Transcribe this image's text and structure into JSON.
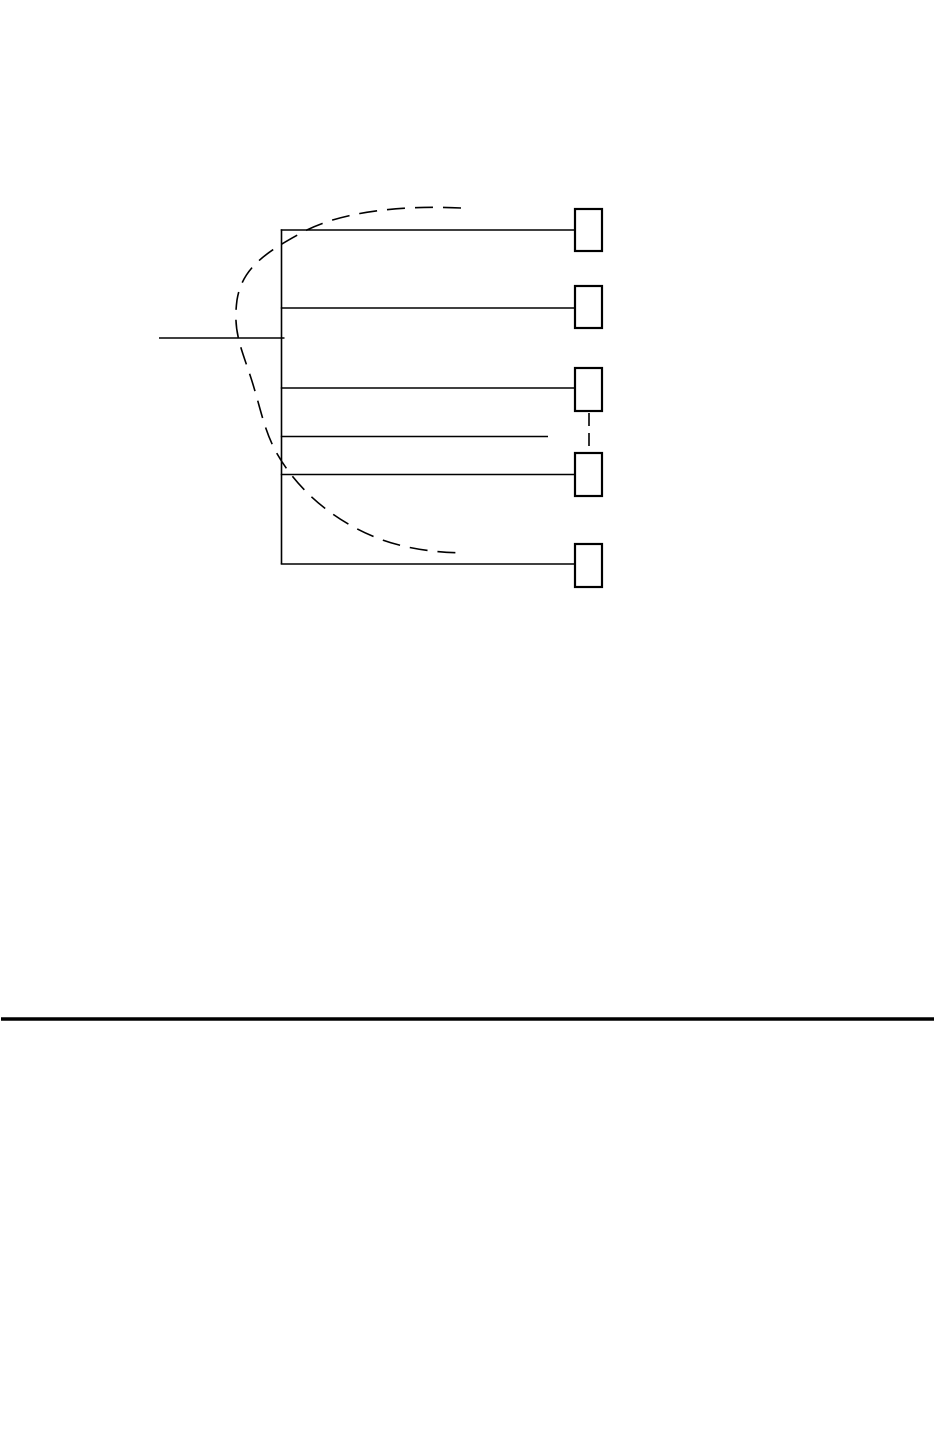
{
  "page": {
    "width": 936,
    "height": 1440,
    "background_color": "#ffffff"
  },
  "figure": {
    "description": "Fan-out line diagram: a vertical bus with horizontal branch lines ending in empty terminal boxes, a dashed grouping arc, a dashed ellipsis connector between boxes, and an input line entering from the left; a full-width separator rule sits lower on the page.",
    "stroke_color": "#000000",
    "line_width": 1.6,
    "box_stroke_width": 2.2,
    "box_fill": "#ffffff",
    "lines": [
      {
        "name": "bus-line",
        "x1": 281.5,
        "y1": 229.2,
        "x2": 281.5,
        "y2": 564
      },
      {
        "name": "branch-line-1",
        "x1": 280.7,
        "y1": 230,
        "x2": 575,
        "y2": 230
      },
      {
        "name": "branch-line-2",
        "x1": 280.7,
        "y1": 308,
        "x2": 578,
        "y2": 308
      },
      {
        "name": "branch-line-3",
        "x1": 280.7,
        "y1": 388,
        "x2": 575,
        "y2": 388
      },
      {
        "name": "branch-line-4-short",
        "x1": 280.7,
        "y1": 436.5,
        "x2": 548,
        "y2": 436.5
      },
      {
        "name": "branch-line-5",
        "x1": 280.7,
        "y1": 474.5,
        "x2": 575,
        "y2": 474.5
      },
      {
        "name": "branch-line-6",
        "x1": 280.7,
        "y1": 564,
        "x2": 574.5,
        "y2": 564
      },
      {
        "name": "input-line",
        "x1": 159,
        "y1": 338,
        "x2": 284.5,
        "y2": 338
      }
    ],
    "boxes": [
      {
        "name": "terminal-box-1",
        "x": 575,
        "y": 209,
        "w": 27,
        "h": 42
      },
      {
        "name": "terminal-box-2",
        "x": 575,
        "y": 286,
        "w": 27,
        "h": 42
      },
      {
        "name": "terminal-box-3",
        "x": 575,
        "y": 368,
        "w": 27,
        "h": 43
      },
      {
        "name": "terminal-box-4",
        "x": 575,
        "y": 453,
        "w": 27,
        "h": 43
      },
      {
        "name": "terminal-box-5",
        "x": 575,
        "y": 544,
        "w": 27,
        "h": 43
      }
    ],
    "dashed_lines": [
      {
        "name": "ellipsis-connector",
        "x1": 589,
        "y1": 413,
        "x2": 589,
        "y2": 451,
        "dash": "13 7"
      }
    ],
    "arc": {
      "name": "grouping-arc",
      "path": "M 461 208 C 400 205 340 212 303 232 C 266 252 242 268 237 300 C 233 330 240 345 250 375 C 260 405 263 427 275 450 C 290 478 315 505 350 525 C 385 545 420 552 464 553",
      "dash": "18 10",
      "width": 1.6
    },
    "separator": {
      "name": "separator-rule",
      "x1": 1,
      "y1": 1019,
      "x2": 934,
      "y2": 1019,
      "width": 3.4
    }
  }
}
